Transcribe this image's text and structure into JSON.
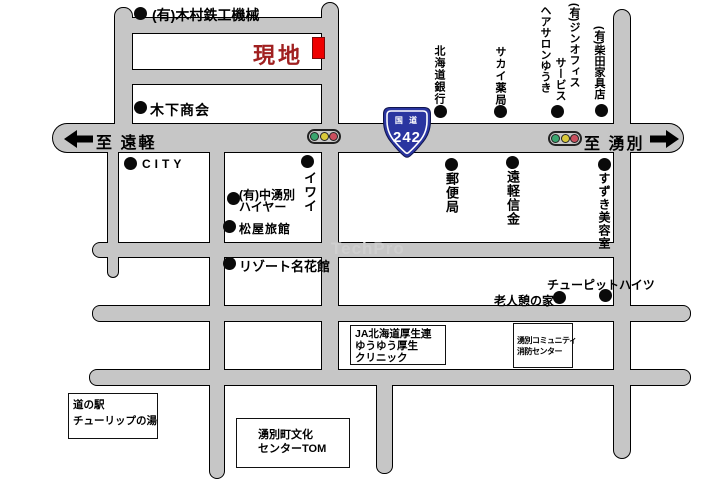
{
  "colors": {
    "road": "#c6c6c6",
    "site_red": "#ee0000",
    "site_text": "#a02020",
    "route_blue": "#2a35a0",
    "signal_green": "#3aa56e",
    "signal_yellow": "#d9c93a",
    "signal_red": "#c94f5e",
    "watermark_gray": "#cfcfcf"
  },
  "site_label": "現地",
  "watermark": "TechPro",
  "route_sign": {
    "category": "国 道",
    "number": "242"
  },
  "directions": {
    "left": "至 遠軽",
    "right": "至 湧別"
  },
  "labels": {
    "kimura": "(有)木村鉄工機械",
    "kinoshita": "木下商会",
    "city": "CITY",
    "iwai": "イワイ",
    "nakayubetsu_line1": "(有)中湧別",
    "nakayubetsu_line2": "ハイヤー",
    "matsuya": "松屋旅館",
    "resort": "リゾート名花館",
    "hokkaido_bank": "北海道銀行",
    "sakai_pharmacy": "サカイ薬局",
    "salon_col1": "(有)ジンオフィス",
    "salon_col2": "サービス",
    "salon_col3": "ヘアサロンゆうき",
    "shibata": "(有)柴田家具店",
    "post_office": "郵便局",
    "engaru_shinkin": "遠軽信金",
    "suzuki_salon": "すずき美容室",
    "chupit_heights": "チューピットハイツ",
    "roujin_ikoi": "老人憩の家"
  },
  "boxes": {
    "michinoeki": [
      "道の駅",
      "チューリップの湯"
    ],
    "bunka_center": [
      "湧別町文化",
      "センターTOM"
    ],
    "ja_clinic": [
      "JA北海道厚生連",
      "ゆうゆう厚生",
      "クリニック"
    ],
    "fire_center": [
      "湧別コミュニティ",
      "消防センター"
    ]
  }
}
